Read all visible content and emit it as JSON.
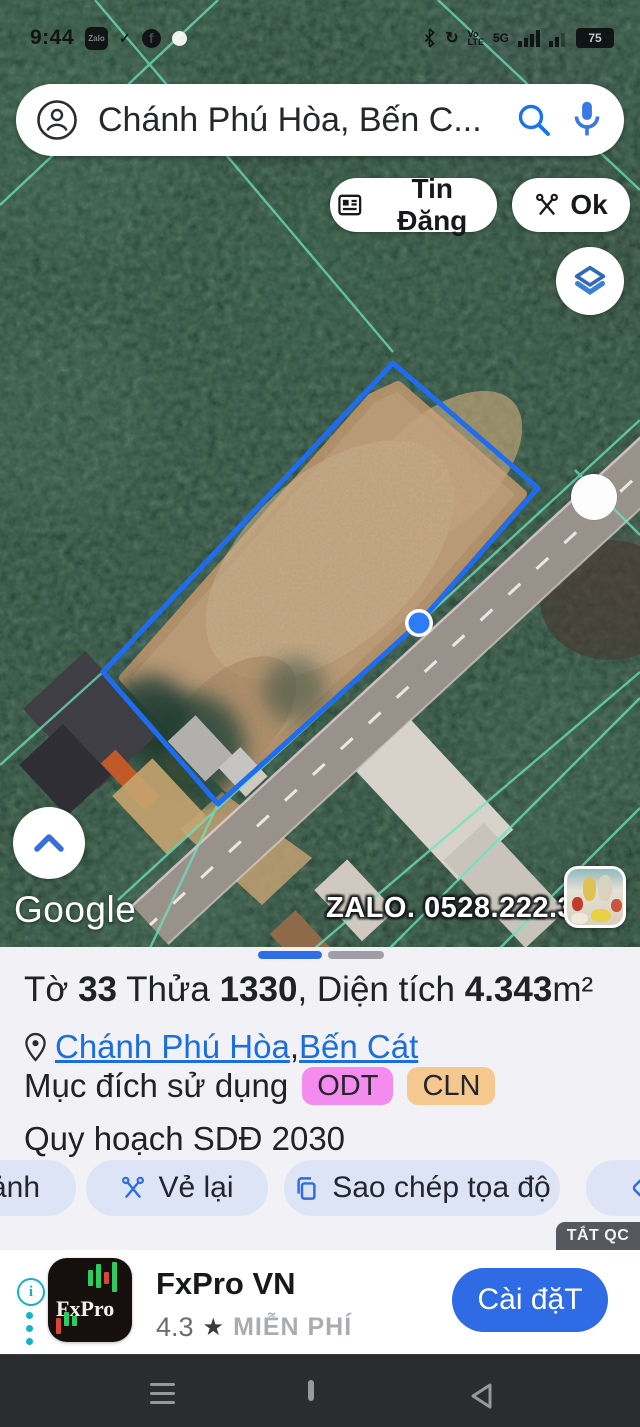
{
  "status_bar": {
    "time": "9:44",
    "zalo_icon_label": "Zalo",
    "facebook_icon_label": "f",
    "check_glyph": "✓",
    "volte": {
      "top": "Vo",
      "bottom": "LTE"
    },
    "network_label": "5G",
    "battery_level": "75",
    "icons": [
      "zalo-icon",
      "check-icon",
      "facebook-icon",
      "notification-dot",
      "bluetooth-icon",
      "sync-icon",
      "volte-icon",
      "5g-icon",
      "signal-bars-icon",
      "signal-bars-2-icon",
      "battery-icon"
    ]
  },
  "search_bar": {
    "query": "Chánh Phú Hòa, Bến C...",
    "icons": [
      "account-icon",
      "search-icon",
      "mic-icon"
    ]
  },
  "map_buttons": {
    "tin_dang_label": "Tin Đăng",
    "ok_label": "Ok",
    "icons": [
      "article-icon",
      "scissors-icon",
      "layers-icon",
      "chevron-up-icon"
    ]
  },
  "map": {
    "google_watermark": "Google",
    "zalo_ad_overlay": "ZALO. 0528.222.333",
    "parcel_outline_points": "393,363 538,488 419,623 218,804 103,672",
    "polygon_color": "#1e6df0",
    "marker_color": "#2e7bf6"
  },
  "panel": {
    "pagination": {
      "pages": 2,
      "active_index": 0
    },
    "title": {
      "p1": "Tờ ",
      "sheet_no": "33",
      "p2": " Thửa ",
      "plot_no": "1330",
      "p3": ", Diện tích ",
      "area": "4.343",
      "unit": "m²"
    },
    "location": {
      "commune": "Chánh Phú Hòa",
      "separator": ", ",
      "district": "Bến Cát",
      "link_color": "#1a6ede"
    },
    "usage": {
      "label": "Mục đích sử dụng",
      "badges": [
        {
          "code": "ODT",
          "bg": "#f48bef"
        },
        {
          "code": "CLN",
          "bg": "#f5c88f"
        }
      ]
    },
    "planning": "Quy hoạch SDĐ 2030",
    "actions": {
      "photo_label": "ảnh",
      "redraw_label": "Vẻ lại",
      "copy_label": "Sao chép tọa độ",
      "icons": [
        "scissors-icon",
        "copy-icon",
        "directions-icon"
      ]
    }
  },
  "ad": {
    "dismiss_label": "TẮT QC",
    "app_icon_text": "FxPro",
    "app_name": "FxPro VN",
    "rating": "4.3",
    "star": "★",
    "price_label": "MIỄN PHÍ",
    "install_label": "Cài đặT",
    "accent": "#2e6be5"
  },
  "colors": {
    "accent_blue": "#1a73e8",
    "panel_bg": "#f2f1f5",
    "action_pill_bg": "#dde4f5",
    "nav_bg": "#2b2c2f"
  }
}
